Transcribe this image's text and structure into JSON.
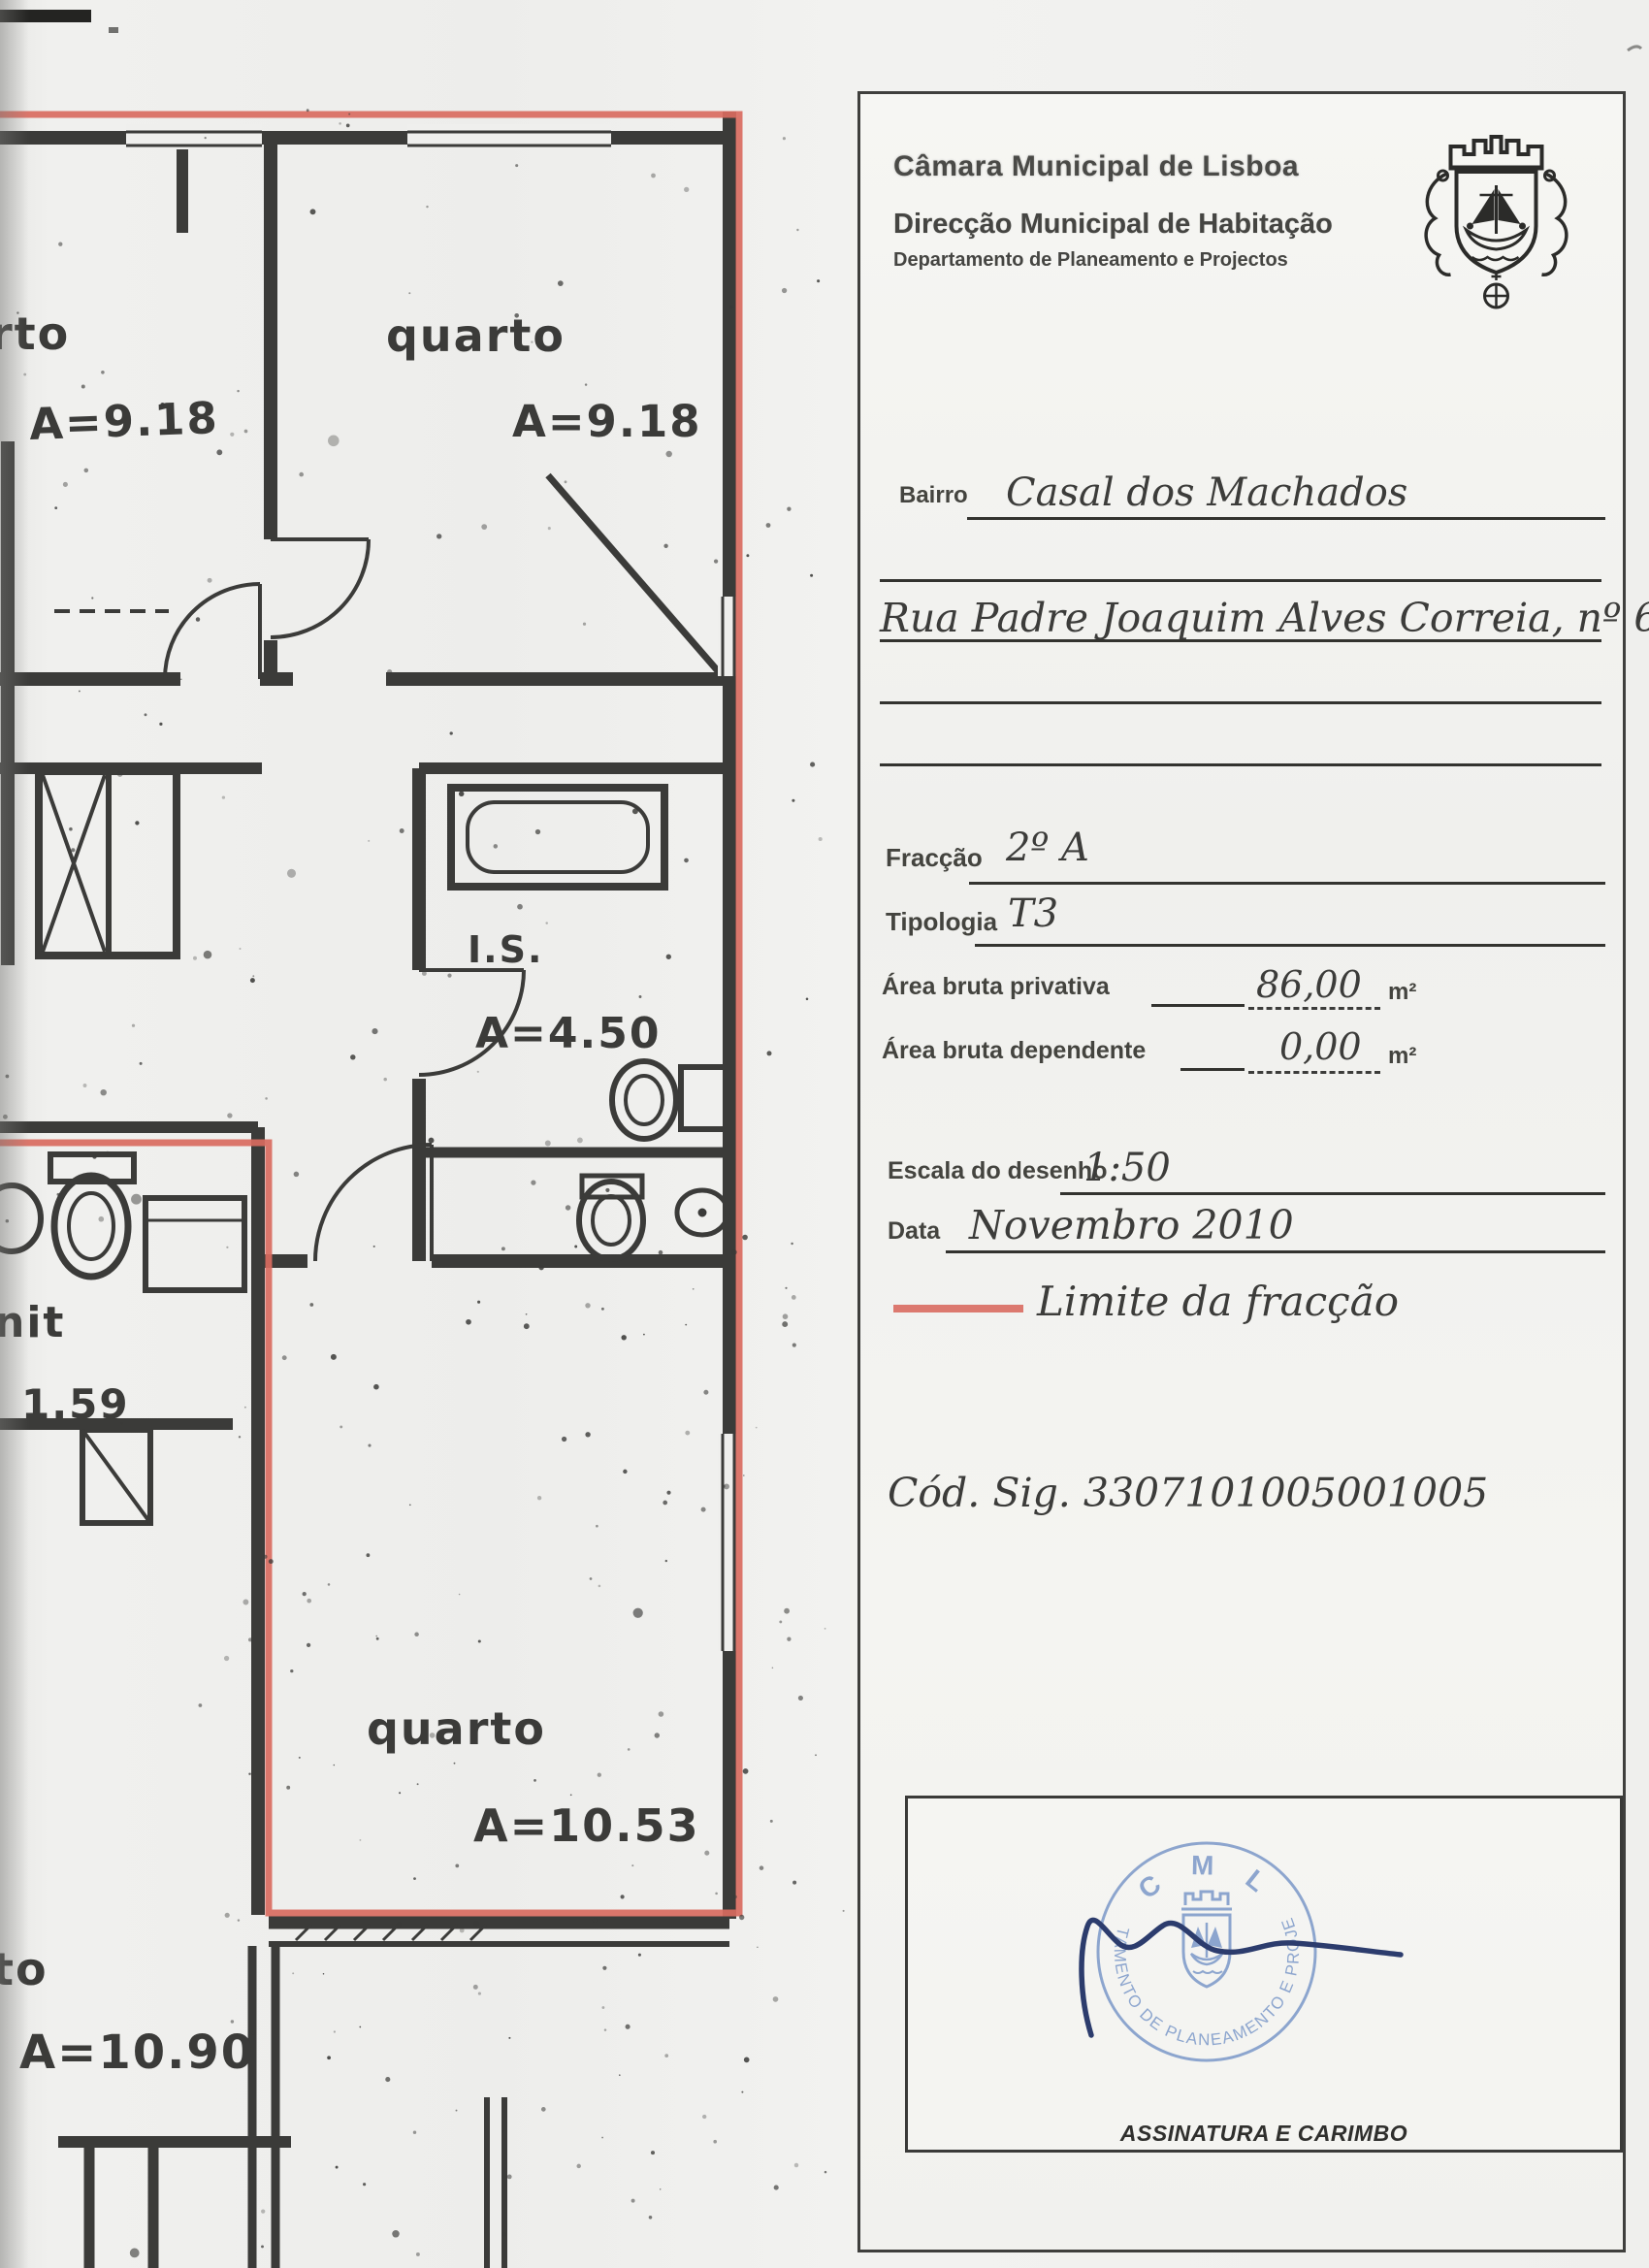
{
  "form": {
    "org": "Câmara Municipal de Lisboa",
    "direccao": "Direcção Municipal de Habitação",
    "departamento": "Departamento de Planeamento e Projectos",
    "bairro": {
      "label": "Bairro",
      "value": "Casal dos Machados"
    },
    "morada": {
      "value": "Rua Padre Joaquim Alves Correia, nº 6"
    },
    "fraccao": {
      "label": "Fracção",
      "value": "2º A"
    },
    "tipologia": {
      "label": "Tipologia",
      "value": "T3"
    },
    "area_privativa": {
      "label": "Área bruta privativa",
      "value": "86,00",
      "unit": "m²"
    },
    "area_dependente": {
      "label": "Área bruta dependente",
      "value": "0,00",
      "unit": "m²"
    },
    "escala": {
      "label": "Escala do desenho",
      "value": "1:50"
    },
    "data": {
      "label": "Data",
      "value": "Novembro 2010"
    },
    "legenda": {
      "label": "Limite da fracção"
    },
    "cod_sig": "Cód. Sig. 3307101005001005",
    "assinatura": {
      "label": "ASSINATURA E CARIMBO",
      "stamp_top": "C M L",
      "stamp_ring": "DEPARTAMENTO DE PLANEAMENTO E PROJECTOS"
    }
  },
  "floorplan": {
    "labels": {
      "quarto_tl_partial": "rto",
      "quarto_tl_area": "A=9.18",
      "quarto_tc": "quarto",
      "quarto_tc_area": "A=9.18",
      "is": "I.S.",
      "is_area": "A=4.50",
      "nit_partial": "nit",
      "nit_area": "1.59",
      "quarto_b": "quarto",
      "quarto_b_area": "A=10.53",
      "quarto_bl_partial": "to",
      "quarto_bl_area": "A=10.90"
    }
  },
  "colors": {
    "boundary_red": "#d96b60",
    "wall": "#3b3b39",
    "stamp_blue": "#7b98c8",
    "signature_blue": "#2c3c6d"
  }
}
